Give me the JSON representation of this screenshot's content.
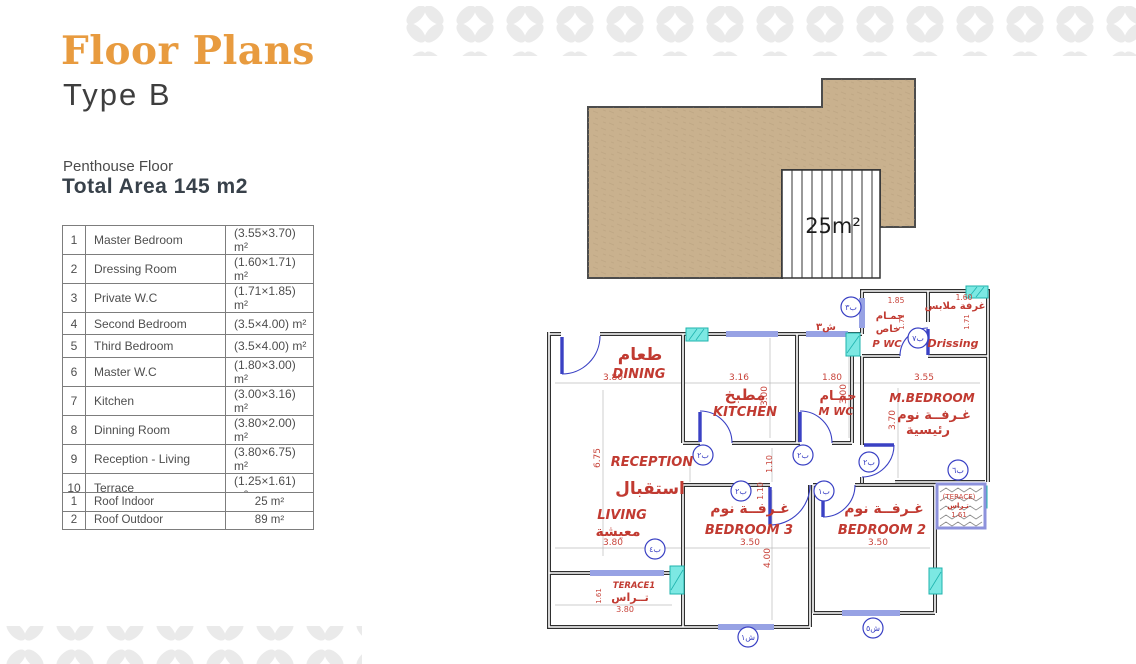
{
  "header": {
    "title": "Floor Plans",
    "subtitle": "Type B",
    "floor_label": "Penthouse Floor",
    "total_area_label": "Total Area 145 m2"
  },
  "rooms_table": {
    "rows": [
      {
        "num": "1",
        "name": "Master Bedroom",
        "dims": "(3.55×3.70) m²"
      },
      {
        "num": "2",
        "name": "Dressing Room",
        "dims": "(1.60×1.71) m²"
      },
      {
        "num": "3",
        "name": "Private W.C",
        "dims": "(1.71×1.85) m²"
      },
      {
        "num": "4",
        "name": "Second Bedroom",
        "dims": "(3.5×4.00) m²"
      },
      {
        "num": "5",
        "name": "Third Bedroom",
        "dims": "(3.5×4.00) m²"
      },
      {
        "num": "6",
        "name": "Master W.C",
        "dims": "(1.80×3.00) m²"
      },
      {
        "num": "7",
        "name": "Kitchen",
        "dims": "(3.00×3.16) m²"
      },
      {
        "num": "8",
        "name": "Dinning Room",
        "dims": "(3.80×2.00) m²"
      },
      {
        "num": "9",
        "name": "Reception - Living",
        "dims": "(3.80×6.75) m²"
      },
      {
        "num": "10",
        "name": "Terrace",
        "dims": "(1.25×1.61) m²"
      }
    ]
  },
  "roof_table": {
    "rows": [
      {
        "num": "1",
        "name": "Roof Indoor",
        "area": "25 m²"
      },
      {
        "num": "2",
        "name": "Roof Outdoor",
        "area": "89 m²"
      }
    ]
  },
  "plan": {
    "roof": {
      "stairs_area": "25m²"
    },
    "street_tag": "ش٣",
    "rooms": {
      "dining": {
        "ar": "طعام",
        "en": "DINING",
        "w": "3.80"
      },
      "kitchen": {
        "ar": "مطبخ",
        "en": "KITCHEN",
        "w": "3.16",
        "h": "3.00"
      },
      "mwc": {
        "ar": "حمـام",
        "en": "M WC",
        "w": "1.80",
        "h": "3.00"
      },
      "pwc": {
        "ar1": "حمـام",
        "ar2": "خاص",
        "en": "P WC",
        "w": "1.85",
        "h": "1.71"
      },
      "dressing": {
        "ar": "غرفة ملابس",
        "en": "Drissing",
        "w": "1.60",
        "h": "1.71"
      },
      "mbedroom": {
        "en": "M.BEDROOM",
        "ar1": "غـرفــة نوم",
        "ar2": "رئيسية",
        "w": "3.55",
        "h": "3.70"
      },
      "reception": {
        "en": "RECEPTION",
        "ar": "استقبال",
        "h": "6.75"
      },
      "living": {
        "en": "LIVING",
        "ar": "معيشة",
        "w": "3.80"
      },
      "terrace1": {
        "en": "TERACE1",
        "ar": "تــراس",
        "w": "3.80",
        "h": "1.61"
      },
      "bedroom3": {
        "ar": "غـرفــة نوم",
        "en": "BEDROOM 3",
        "w": "3.50",
        "h": "4.00"
      },
      "bedroom2": {
        "ar": "غـرفــة نوم",
        "en": "BEDROOM 2",
        "w": "3.50"
      },
      "terrace2": {
        "en": "(TERACE)",
        "ar": "تـراس",
        "w": "1.61"
      },
      "hall": {
        "d1": "1.10",
        "d2": "1.10"
      }
    },
    "tags": [
      "ب٢",
      "ب٢",
      "ب٢",
      "ب١",
      "ب٢",
      "ب٦",
      "ب٤",
      "ب٣",
      "ب٧",
      "ش١",
      "ش٥"
    ]
  },
  "colors": {
    "accent_orange": "#E89B3F",
    "label_red": "#C13A31",
    "wall_dark": "#2F2F2F",
    "door_blue": "#3A41C4",
    "window_teal": "#1FB3AE",
    "roof_tan": "#C9B18E"
  }
}
